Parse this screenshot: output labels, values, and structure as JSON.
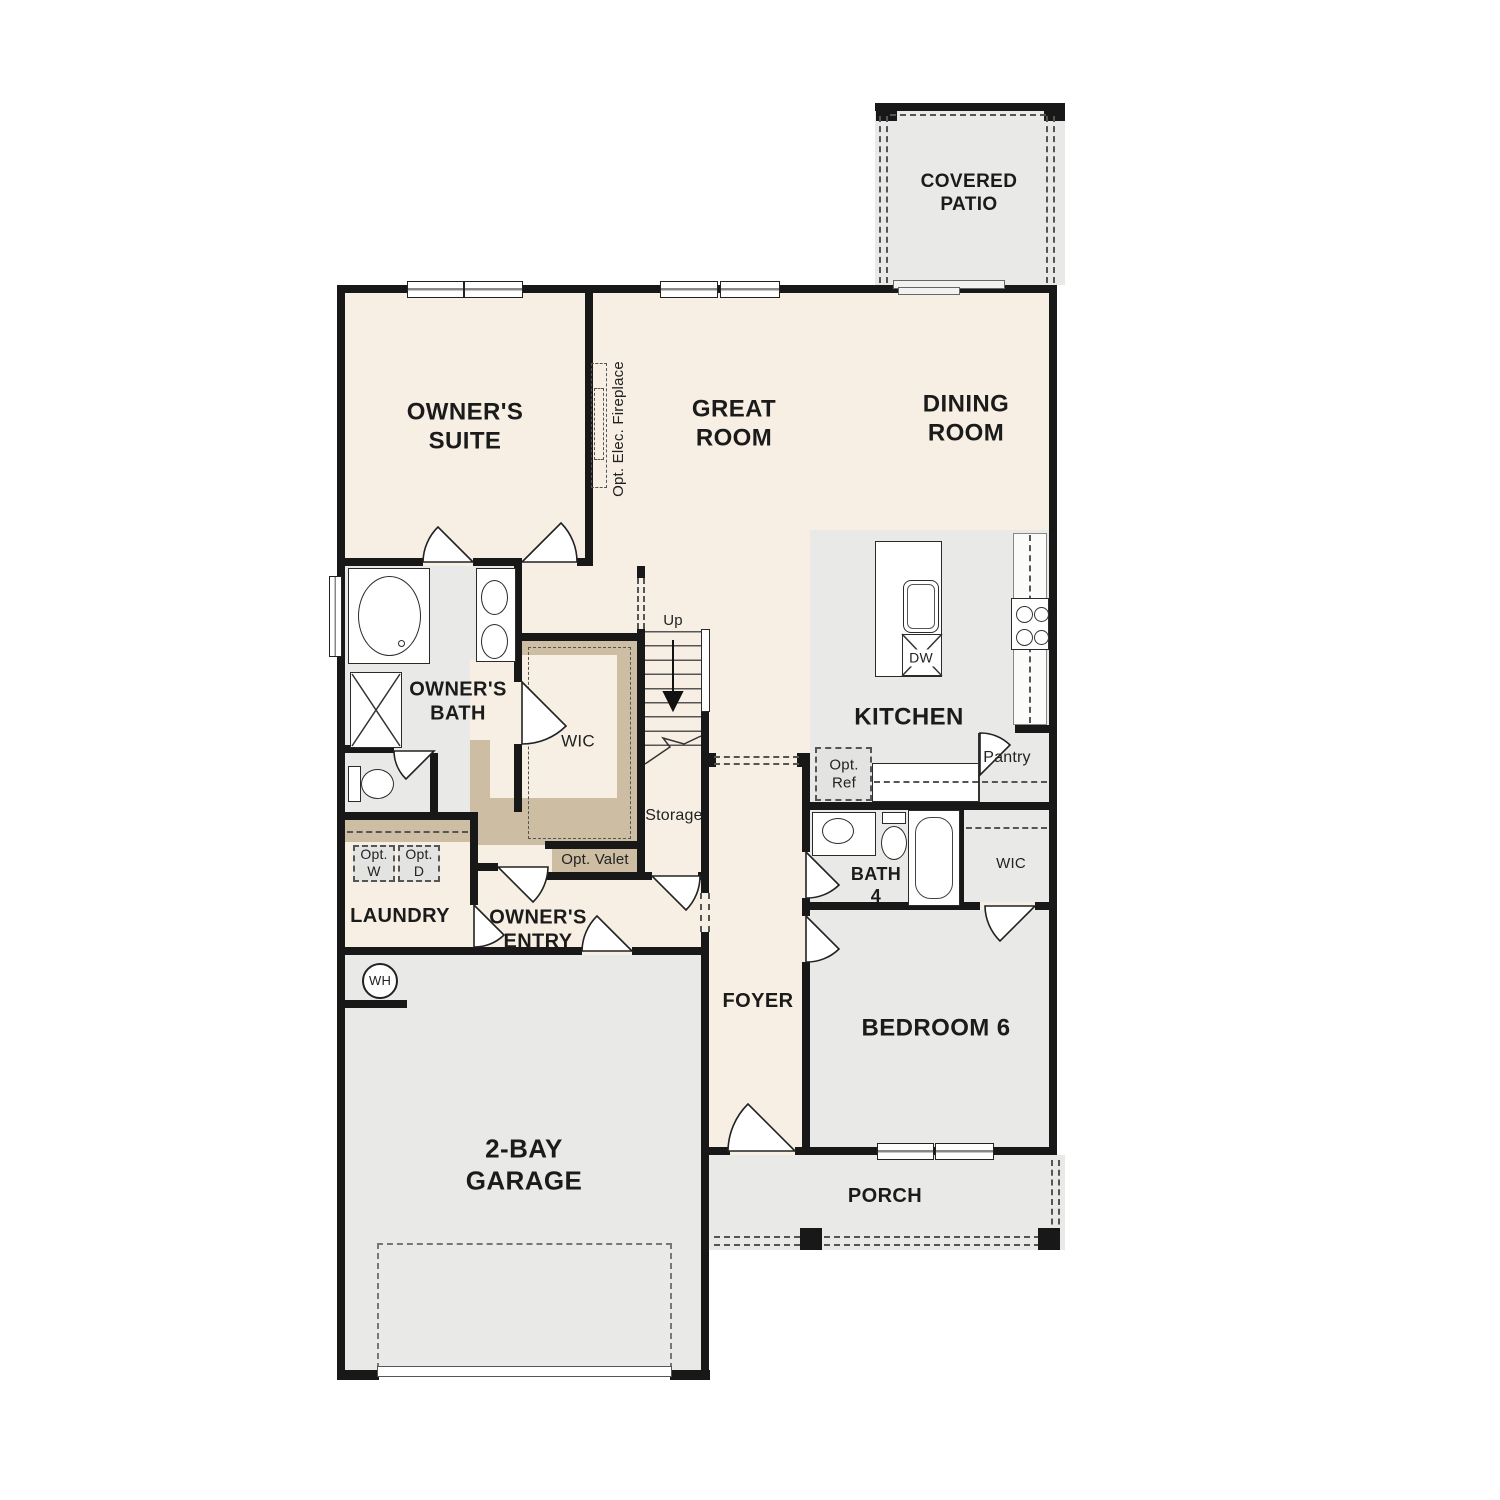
{
  "rooms": {
    "covered_patio": {
      "label": "COVERED\nPATIO"
    },
    "owners_suite": {
      "label": "OWNER'S\nSUITE"
    },
    "great_room": {
      "label": "GREAT\nROOM"
    },
    "dining_room": {
      "label": "DINING\nROOM"
    },
    "kitchen": {
      "label": "KITCHEN"
    },
    "owners_bath": {
      "label": "OWNER'S\nBATH"
    },
    "wic_owners": {
      "label": "WIC"
    },
    "storage": {
      "label": "Storage"
    },
    "laundry": {
      "label": "LAUNDRY"
    },
    "owners_entry": {
      "label": "OWNER'S\nENTRY"
    },
    "foyer": {
      "label": "FOYER"
    },
    "bath_4": {
      "label": "BATH\n4"
    },
    "wic_bedroom6": {
      "label": "WIC"
    },
    "bedroom_6": {
      "label": "BEDROOM 6"
    },
    "garage": {
      "label": "2-BAY\nGARAGE"
    },
    "porch": {
      "label": "PORCH"
    }
  },
  "annotations": {
    "stairs_up": "Up",
    "opt_elec_fireplace": "Opt. Elec. Fireplace",
    "opt_ref": "Opt.\nRef",
    "pantry": "Pantry",
    "dishwasher": "DW",
    "opt_washer": "Opt.\nW",
    "opt_dryer": "Opt.\nD",
    "opt_valet": "Opt. Valet",
    "water_heater": "WH"
  },
  "colors": {
    "floor_cream": "#f7efe3",
    "floor_gray": "#e9e9e7",
    "shelf_tan": "#ccbda3",
    "appliance_gray": "#e3e3e1",
    "wall": "#181818"
  }
}
